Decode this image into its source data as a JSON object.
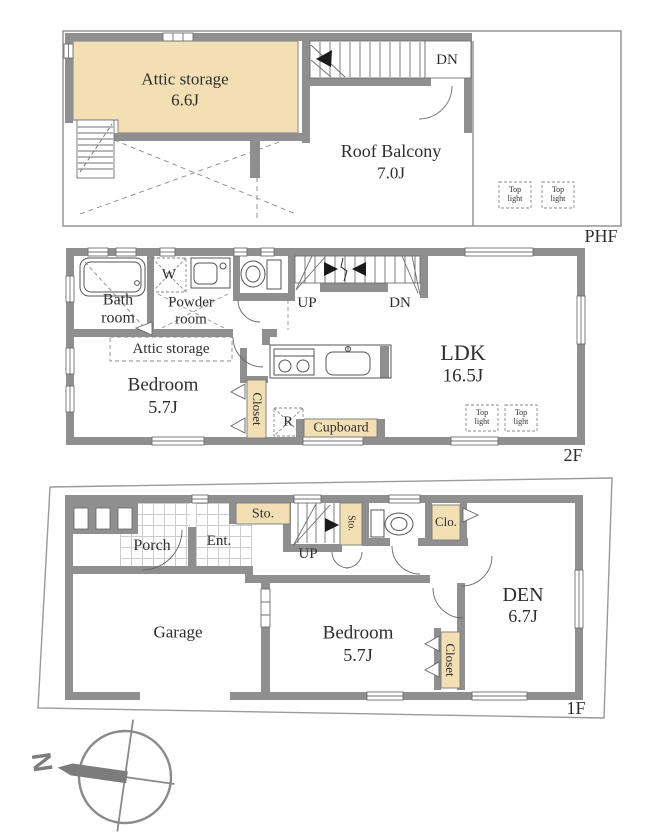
{
  "title": "House floor plan (PHF / 2F / 1F)",
  "colors": {
    "wall": "#8f8f8f",
    "accent_tan": "#f3dfb4",
    "text": "#2e2e2e",
    "compass": "#7c7c7c"
  },
  "phf": {
    "floor_label": "PHF",
    "attic_storage_name": "Attic storage",
    "attic_storage_size": "6.6J",
    "roof_balcony_name": "Roof Balcony",
    "roof_balcony_size": "7.0J",
    "stairs_down": "DN",
    "top_light_1": "Top light",
    "top_light_2": "Top light"
  },
  "f2": {
    "floor_label": "2F",
    "bath_room": "Bath room",
    "washer": "W",
    "powder_room": "Powder room",
    "stairs_up": "UP",
    "stairs_down": "DN",
    "attic_storage": "Attic storage",
    "bedroom_name": "Bedroom",
    "bedroom_size": "5.7J",
    "closet": "Closet",
    "refrigerator": "R",
    "cupboard": "Cupboard",
    "ldk_name": "LDK",
    "ldk_size": "16.5J",
    "top_light_1": "Top light",
    "top_light_2": "Top light"
  },
  "f1": {
    "floor_label": "1F",
    "porch": "Porch",
    "entrance": "Ent.",
    "storage_1": "Sto.",
    "storage_2": "Sto.",
    "stairs_up": "UP",
    "closet_small": "Clo.",
    "den_name": "DEN",
    "den_size": "6.7J",
    "garage": "Garage",
    "bedroom_name": "Bedroom",
    "bedroom_size": "5.7J",
    "closet": "Closet"
  },
  "compass": {
    "north": "N"
  }
}
